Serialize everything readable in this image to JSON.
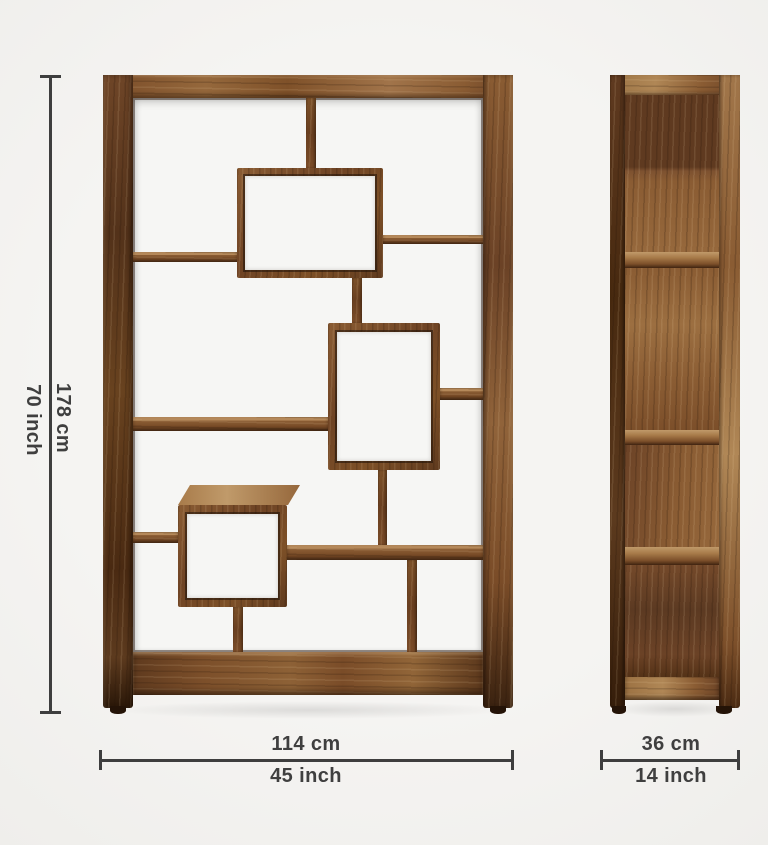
{
  "dimensions": {
    "height": {
      "metric": "178 cm",
      "imperial": "70 inch"
    },
    "width": {
      "metric": "114 cm",
      "imperial": "45 inch"
    },
    "depth": {
      "metric": "36 cm",
      "imperial": "14 inch"
    }
  },
  "style": {
    "background": "#f4f3f1",
    "annotation_line_color": "#3e3e3e",
    "annotation_text_color": "#3f3f3f",
    "wood_dark": "#4f2e16",
    "wood_medium": "#8a5c33",
    "wood_light": "#a87b4a",
    "opening_fill": "#f6f6f4"
  }
}
